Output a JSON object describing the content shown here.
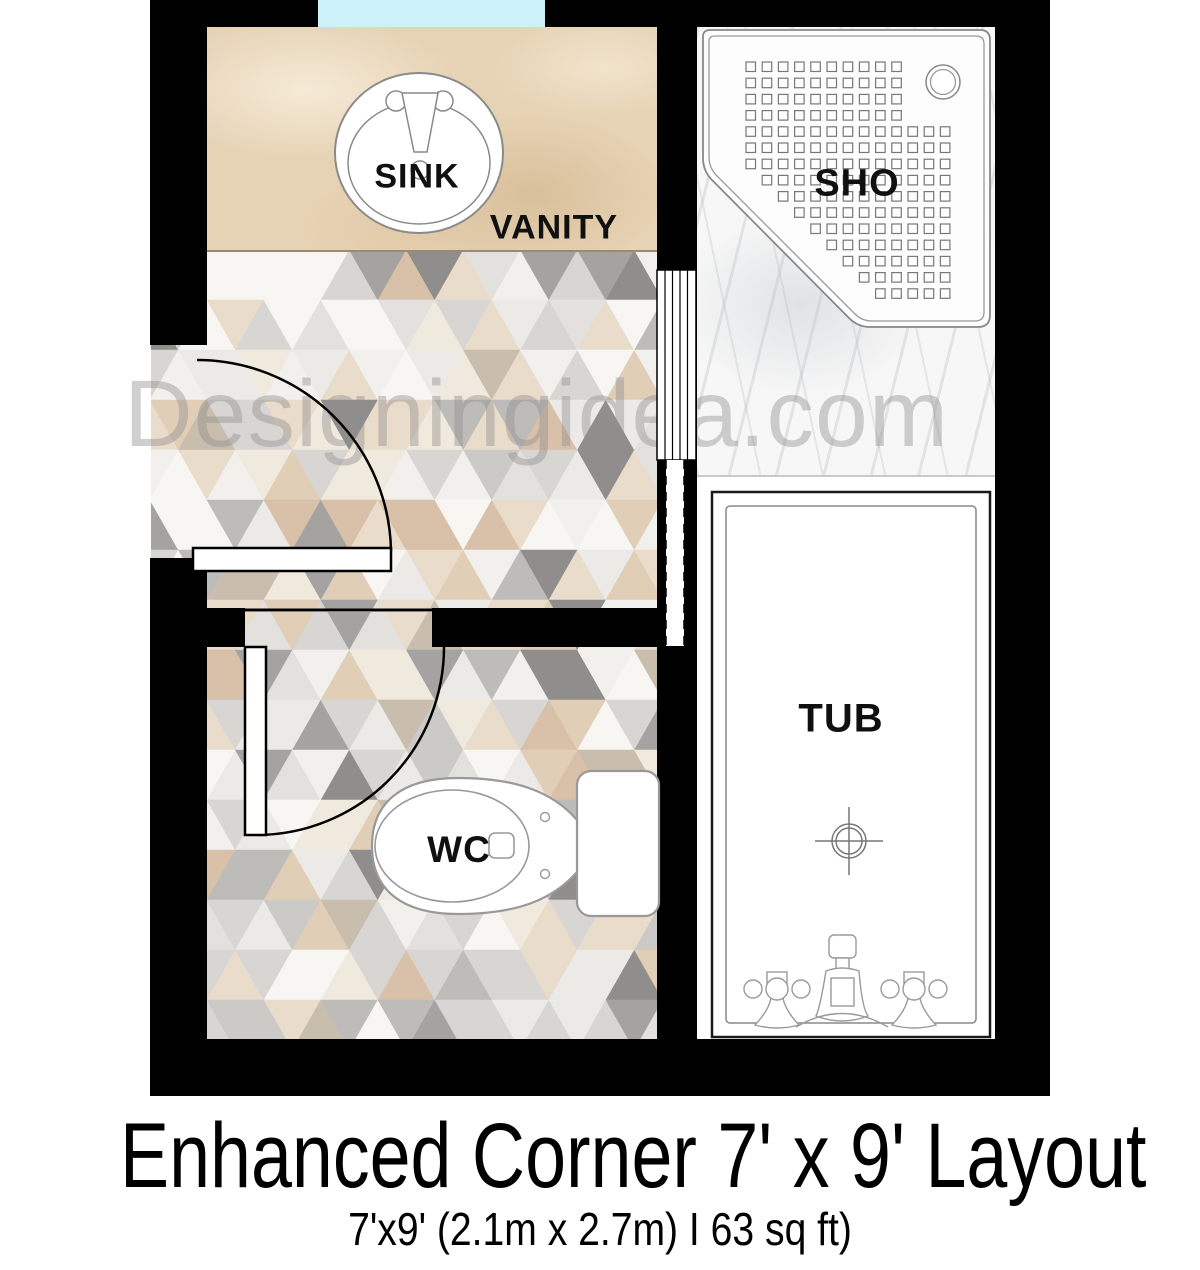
{
  "labels": {
    "sink": "SINK",
    "vanity": "VANITY",
    "shower": "SHO",
    "toilet": "WC",
    "tub": "TUB"
  },
  "watermark": "Designingidea.com",
  "footer": {
    "title": "Enhanced Corner 7' x 9' Layout",
    "subtitle": "7'x9' (2.1m x 2.7m) I 63 sq ft)"
  },
  "colors": {
    "wall": "#000000",
    "window": "#cdf1f8",
    "vanity_base": "#e6d2b4",
    "marble_base": "#f7f7f7",
    "fixture_line": "#8a8a8a",
    "floor_palette": [
      "#f7f6f3",
      "#f7f6f3",
      "#f2f0ed",
      "#eceae7",
      "#eceae7",
      "#e3e1de",
      "#d8d6d3",
      "#d8d6d3",
      "#cccac7",
      "#bebcb9",
      "#a5a3a1",
      "#908e8c",
      "#e9dccb",
      "#e9dccb",
      "#e0ceb7",
      "#d9c0a9",
      "#f0e9dd",
      "#c9bdae"
    ]
  }
}
